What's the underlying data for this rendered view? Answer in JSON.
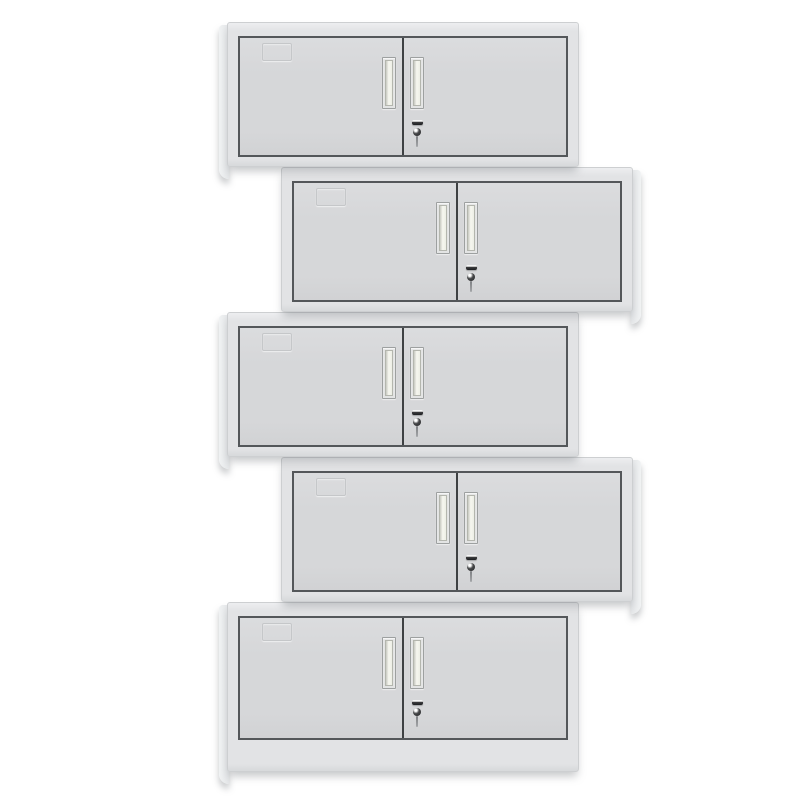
{
  "scene": {
    "type": "product-photo",
    "subject": "Five identical two-door light-grey steel wall cabinets stacked vertically in an alternating zigzag (staggered) pattern on a plain white background",
    "background_color": "#ffffff",
    "cabinet_count": 5
  },
  "colors": {
    "background": "#ffffff",
    "frame": "#e2e3e5",
    "frame_top_highlight": "#edeef0",
    "frame_bottom_shade": "#d7d9db",
    "frame_edge": "#cdcfd1",
    "door": "#d6d7d9",
    "door_outline": "#54575a",
    "door_divider": "#3e4143",
    "side_panel": "#e4e6e8",
    "side_panel_highlight": "#f1f3f4",
    "handle_frame": "#e3e4e4",
    "handle_border": "#9da0a0",
    "handle_inner_border": "#b4b6ae",
    "handle_inner_light": "#f6f7f0",
    "handle_inner_dark": "#c8c9c1",
    "label_holder_border": "#c2c4c6",
    "lock_dark": "#1d1e20",
    "lock_highlight": "#ffffff",
    "key_shaft": "#a4a6a9",
    "shadow": "rgba(108,112,117,0.40)"
  },
  "cabinets": [
    {
      "id": 1,
      "foot_side": "left",
      "left": 227,
      "top": 22,
      "width": 352,
      "height": 145,
      "plinth": false,
      "z": 5
    },
    {
      "id": 2,
      "foot_side": "right",
      "left": 281,
      "top": 167,
      "width": 352,
      "height": 145,
      "plinth": false,
      "z": 4
    },
    {
      "id": 3,
      "foot_side": "left",
      "left": 227,
      "top": 312,
      "width": 352,
      "height": 145,
      "plinth": false,
      "z": 3
    },
    {
      "id": 4,
      "foot_side": "right",
      "left": 281,
      "top": 457,
      "width": 352,
      "height": 145,
      "plinth": false,
      "z": 2
    },
    {
      "id": 5,
      "foot_side": "left",
      "left": 227,
      "top": 602,
      "width": 352,
      "height": 170,
      "plinth": true,
      "z": 1
    }
  ],
  "cabinet_parts": {
    "left_door": "left hinged door",
    "right_door": "right hinged door",
    "handles": "two recessed vertical pull handles flanking the center seam",
    "lock": "cam lock with key inserted, below the right-door handle",
    "label_holder": "embossed label card holder on upper-left of left door",
    "plinth": "taller solid base panel on the bottom cabinet"
  }
}
